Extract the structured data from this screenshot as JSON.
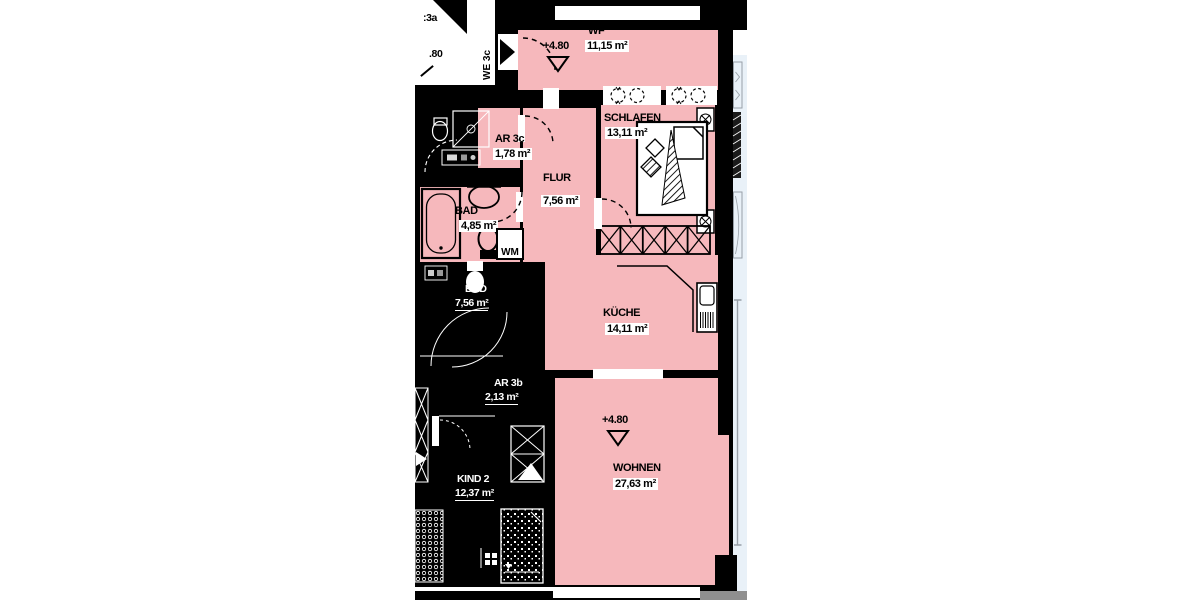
{
  "unit": {
    "entry_arrow_label_vertical": "WE 3c",
    "adjacent_unit_label_partial": ":3a",
    "adjacent_level_partial": ".80",
    "entry_level_marker": "+4.80",
    "living_level_marker": "+4.80",
    "washing_machine_label": "WM"
  },
  "rooms": [
    {
      "name": "WF",
      "area": "11,15 m²"
    },
    {
      "name": "SCHLAFEN",
      "area": "13,11 m²"
    },
    {
      "name": "AR 3c",
      "area": "1,78 m²"
    },
    {
      "name": "FLUR",
      "area": "7,56 m²"
    },
    {
      "name": "BAD",
      "area": "4,85 m²"
    },
    {
      "name": "KÜCHE",
      "area": "14,11 m²"
    },
    {
      "name": "WOHNEN",
      "area": "27,63 m²"
    }
  ],
  "neighbor_rooms": [
    {
      "name": "BAD",
      "area": "7,56 m²"
    },
    {
      "name": "AR 3b",
      "area": "2,13 m²"
    },
    {
      "name": "KIND 2",
      "area": "12,37 m²"
    }
  ],
  "colors": {
    "room_fill": "#f6b8bc",
    "wall": "#000000",
    "balcony_strip": "#e9f1f8",
    "window_frame_gray": "#98a0a8",
    "exterior_gray": "#8f8f8f"
  }
}
